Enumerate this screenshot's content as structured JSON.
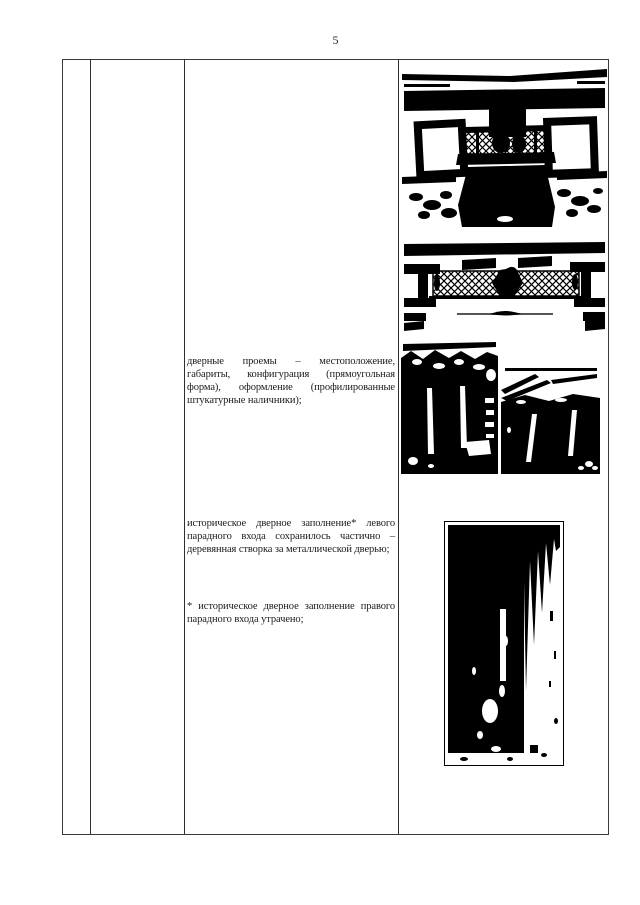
{
  "page": {
    "number": "5"
  },
  "colors": {
    "table_border": "#3a3a3a",
    "grid_line": "#2e2e2e",
    "text": "#1b1b1b",
    "photo_ink": "#000000",
    "photo_paper": "#ffffff"
  },
  "content": {
    "paragraphs": [
      {
        "full_text": "дверные проемы – местоположение, габариты, конфигурация (прямоугольная форма), оформление (профилированные штукатурные наличники);",
        "lines": [
          "дверные проемы – местоположение,",
          "габариты, конфигурация (прямоугольная",
          "форма), оформление (профилированные",
          "штукатурные наличники);"
        ]
      },
      {
        "full_text": "историческое дверное заполнение* левого парадного входа сохранилось частично – деревянная створка за металлической дверью;",
        "lines": [
          "историческое дверное заполнение* левого",
          "парадного входа сохранилось частично –",
          "деревянная створка за металлической дверью;"
        ]
      },
      {
        "full_text": "* историческое дверное заполнение правого парадного входа утрачено;",
        "lines": [
          "* историческое дверное заполнение правого",
          "парадного входа утрачено;"
        ]
      }
    ],
    "photos": [
      {
        "name": "facade-balcony-photo"
      },
      {
        "name": "balcony-railing-photo"
      },
      {
        "name": "entrance-door-left-photo"
      },
      {
        "name": "entrance-door-right-photo"
      },
      {
        "name": "door-leaf-photo"
      }
    ]
  }
}
